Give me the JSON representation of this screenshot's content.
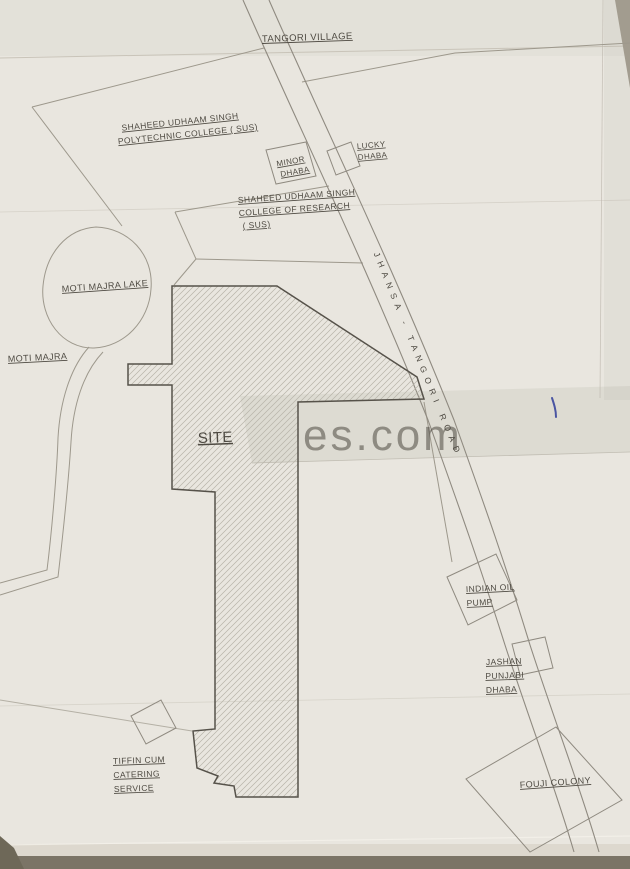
{
  "map": {
    "labels": {
      "tangori_village": "TANGORI VILLAGE",
      "polytechnic": [
        "SHAHEED UDHAAM SINGH",
        "POLYTECHNIC COLLEGE ( SUS)"
      ],
      "research": [
        "SHAHEED UDHAAM SINGH",
        "COLLEGE OF RESEARCH",
        "( SUS)"
      ],
      "minor_dhaba": [
        "MINOR",
        "DHABA"
      ],
      "lucky_dhaba": [
        "LUCKY",
        "DHABA"
      ],
      "moti_majra_lake": "MOTI MAJRA LAKE",
      "moti_majra": "MOTI MAJRA",
      "site": "SITE",
      "road": "JHANSA - TANGORI ROAD",
      "indian_oil": [
        "INDIAN OIL",
        "PUMP"
      ],
      "jashan": [
        "JASHAN",
        "PUNJABI",
        "DHABA"
      ],
      "fouji_colony": "FOUJI COLONY",
      "tiffin": [
        "TIFFIN CUM",
        "CATERING",
        "SERVICE"
      ],
      "watermark": "es.com"
    },
    "colors": {
      "paper": "#e9e6df",
      "ink": "#4e4a42",
      "parcel_line": "#9d988c",
      "road_line": "#8f8a80",
      "site_outline": "#56524a",
      "hatch": "#b7b3a8",
      "pen_mark": "#4a55a2",
      "watermark": "#f6f4ee"
    }
  }
}
